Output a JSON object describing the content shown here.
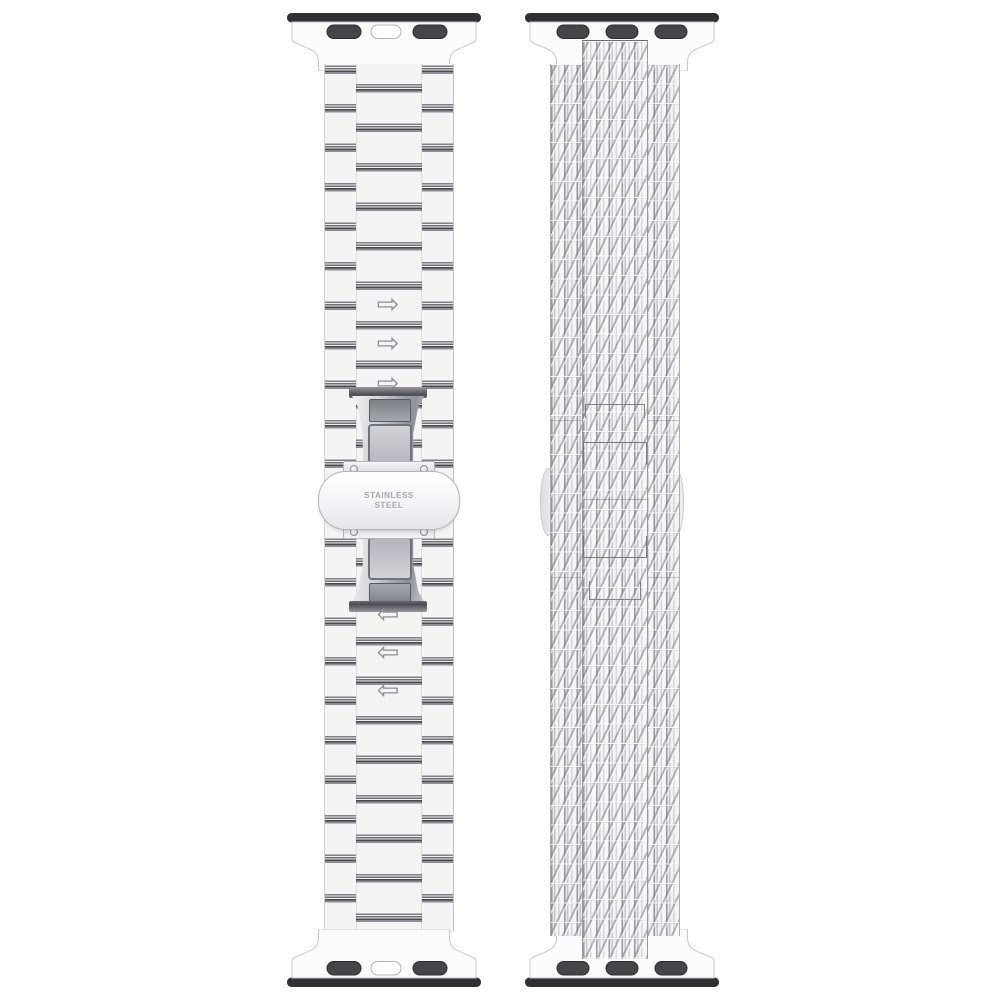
{
  "image": {
    "type": "product-photo",
    "subject": "Two smartwatch replacement straps shown vertically side by side on white",
    "background_color": "#ffffff"
  },
  "left_band": {
    "style": "stainless steel three-row link bracelet with butterfly clasp",
    "clasp": {
      "engraving_line1": "STAINLESS",
      "engraving_line2": "STEEL"
    }
  },
  "right_band": {
    "style": "woven mesh strap with slide buckle and lug connectors"
  },
  "icons": {
    "arrow_right": "⇨",
    "arrow_left": "⇦"
  },
  "colors": {
    "connector_dark": "#39393d",
    "metal_stripe": "#55555a",
    "body_light": "#f4f4f5",
    "mesh_line": "#96969b"
  }
}
